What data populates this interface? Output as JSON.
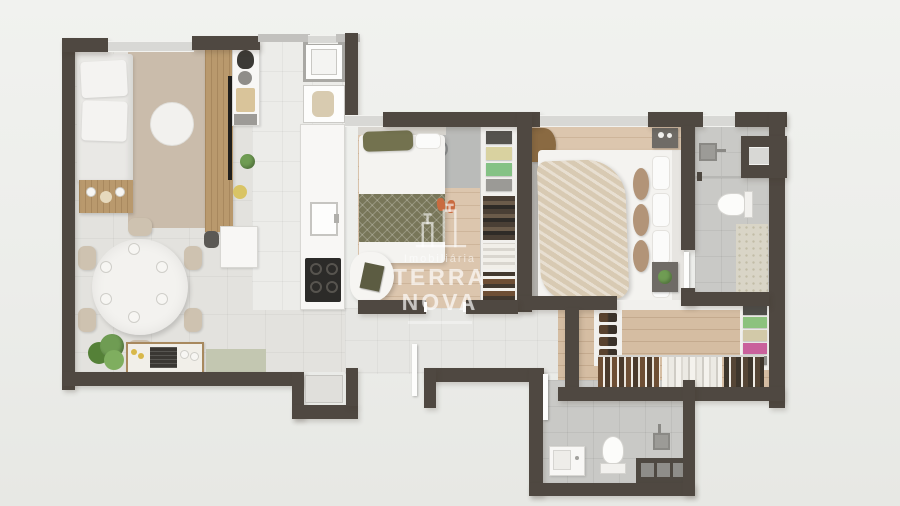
{
  "watermark": {
    "brand_small": "Imobiliária",
    "brand_large": "TERRA NOVA",
    "icon": "buildings-icon"
  },
  "theme": {
    "wall": "#4f4841",
    "wall-thin": "#c2c1be",
    "win": "#d8d8d5",
    "floor-living": "#e3e2de",
    "floor-kitchen": "#ecece9",
    "floor-wood": "#dcc6ae",
    "floor-wood-dark": "#d5bda2",
    "floor-bath": "#c9c9c6",
    "floor-hall": "#e6e6e3",
    "closet-white": "#f1f0ed",
    "rug-tan": "#cabcab",
    "sofa": "#e9e8e5",
    "wood-furniture": "#b9996d",
    "chair-beige": "#cec2b0",
    "plant": "#6f9c53",
    "grill-dark": "#3a3733",
    "mat-green": "#c3c7b1",
    "cooktop": "#2c2b29",
    "bed-white": "#f4f3f0",
    "olive": "#73724f",
    "olive-dark": "#787659",
    "throw-beige": "#d8cab3",
    "nightstand": "#6f6b66",
    "marble": "#d9d5c7",
    "accent-green-stack": "#8cc27e",
    "accent-pink-stack": "#c9619c"
  }
}
